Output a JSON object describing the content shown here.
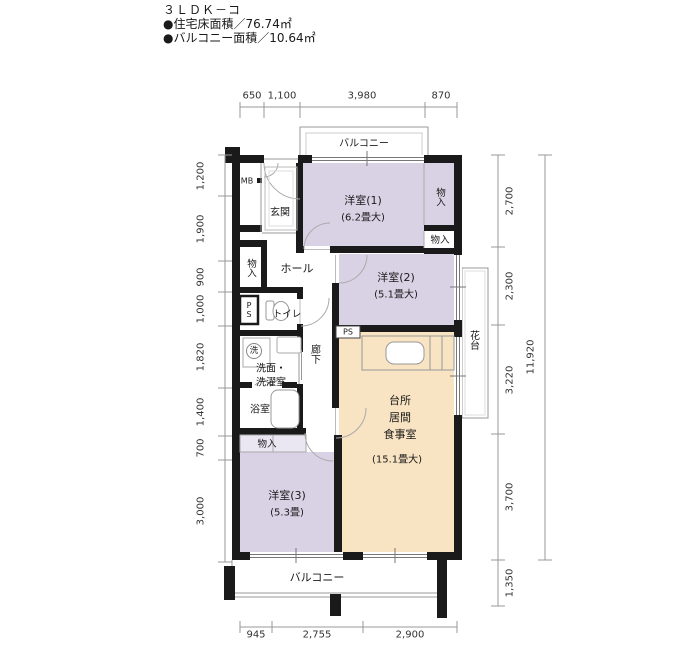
{
  "header": {
    "title": "３ＬＤＫ－コ",
    "floor_area": "●住宅床面積／76.74㎡",
    "balcony_area": "●バルコニー面積／10.64㎡"
  },
  "dims": {
    "top": [
      "650",
      "1,100",
      "3,980",
      "870"
    ],
    "bottom": [
      "945",
      "2,755",
      "2,900"
    ],
    "left": [
      "1,200",
      "1,900",
      "900",
      "1,000",
      "1,820",
      "1,400",
      "700",
      "3,000"
    ],
    "right": [
      "2,700",
      "2,300",
      "3,220",
      "3,700",
      "1,350"
    ],
    "total": "11,920"
  },
  "rooms": {
    "yoshitsu1": {
      "name": "洋室(1)",
      "size": "(6.2畳大)"
    },
    "yoshitsu2": {
      "name": "洋室(2)",
      "size": "(5.1畳大)"
    },
    "yoshitsu3": {
      "name": "洋室(3)",
      "size": "(5.3畳)"
    },
    "ldk": {
      "name1": "台所",
      "name2": "居間",
      "name3": "食事室",
      "size": "(15.1畳大)"
    },
    "genkan": "玄関",
    "hall": "ホール",
    "corridor": "廊下",
    "toilet": "トイレ",
    "washroom1": "洗面・",
    "washroom2": "洗濯室",
    "bath": "浴室",
    "closet_hall": "物入",
    "closet_y1": "物入",
    "closet_y2": "物入",
    "closet_y3": "物入",
    "balcony_top": "バルコニー",
    "balcony_bottom": "バルコニー",
    "mb": "MB",
    "ps": "PS",
    "ps_kitchen": "PS",
    "hanadai": "花台",
    "washer": "洗"
  },
  "colors": {
    "room_purple": "#d9d2e5",
    "room_beige": "#f8e3c2",
    "closet_tint": "#eae6f2",
    "wall": "#1a1a1a"
  }
}
